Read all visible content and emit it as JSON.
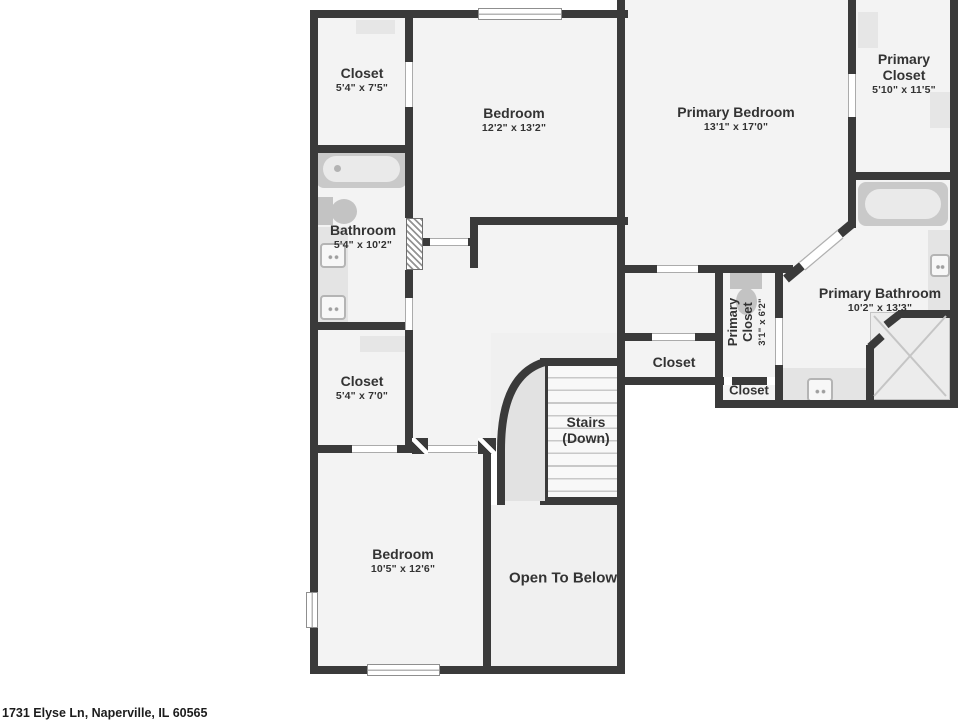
{
  "meta": {
    "address": "1731 Elyse Ln, Naperville, IL 60565"
  },
  "palette": {
    "wall": "#3a3a3a",
    "floor": "#f3f3f3",
    "void": "#e2e2e2",
    "fixture": "#c9c9c9",
    "text": "#333333"
  },
  "rooms": {
    "closet_tl": {
      "name": "Closet",
      "dims": "5'4\" x 7'5\""
    },
    "bedroom_top": {
      "name": "Bedroom",
      "dims": "12'2\" x 13'2\""
    },
    "primary_bedroom": {
      "name": "Primary Bedroom",
      "dims": "13'1\" x 17'0\""
    },
    "primary_closet": {
      "name": "Primary Closet",
      "dims": "5'10\" x 11'5\""
    },
    "bathroom": {
      "name": "Bathroom",
      "dims": "5'4\" x 10'2\""
    },
    "primary_bathroom": {
      "name": "Primary Bathroom",
      "dims": "10'2\" x 13'3\""
    },
    "wc": {
      "name": "Primary Closet",
      "dims": "3'1\" x 6'2\""
    },
    "closet_mid": {
      "name": "Closet"
    },
    "closet_small": {
      "name": "Closet"
    },
    "closet_bl": {
      "name": "Closet",
      "dims": "5'4\" x 7'0\""
    },
    "stairs": {
      "name": "Stairs",
      "sub": "(Down)"
    },
    "bedroom_bottom": {
      "name": "Bedroom",
      "dims": "10'5\" x 12'6\""
    },
    "open_below": {
      "name": "Open To Below"
    }
  }
}
